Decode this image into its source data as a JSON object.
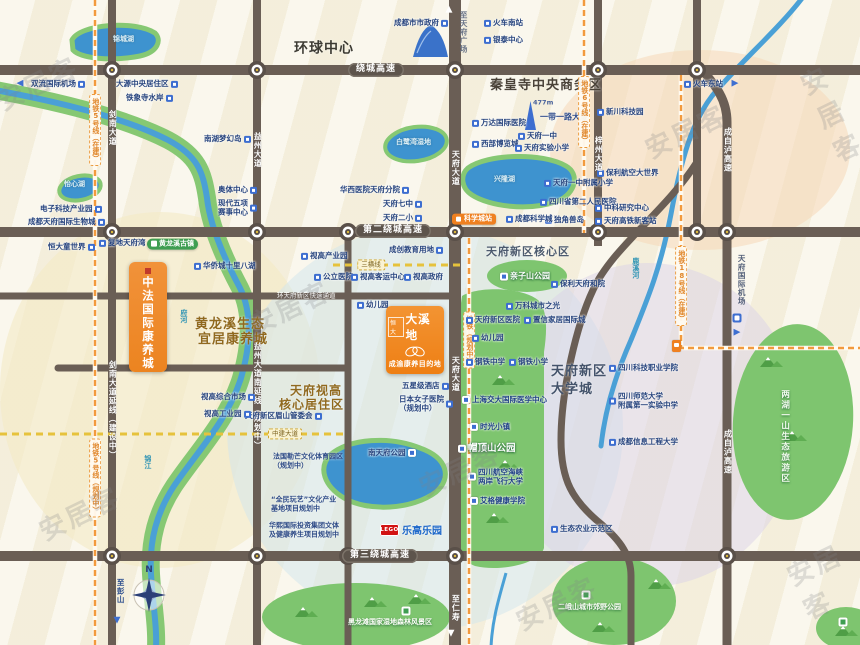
{
  "watermark": {
    "text": "安居客",
    "positions": [
      [
        -6,
        64
      ],
      [
        816,
        54
      ],
      [
        642,
        112
      ],
      [
        246,
        288
      ],
      [
        36,
        494
      ],
      [
        416,
        450
      ],
      [
        793,
        542
      ],
      [
        513,
        584
      ]
    ]
  },
  "projects": {
    "daxidi": {
      "brand": "恒大",
      "name": "大溪地",
      "tagline": "成渝康养目的地"
    },
    "zhongfa": {
      "name": "中法国际康养城"
    }
  },
  "lego": {
    "logo": "LEGO",
    "name": "乐高乐园"
  },
  "compass": {
    "n": "N"
  },
  "colors": {
    "road": "#6a5e55",
    "water": "#4aa0d6",
    "lake": "#3e93cf",
    "green": "#7ec56f",
    "riverbank": "#86c873",
    "metro_dash": "#f29a3d",
    "yellow_dash": "#e6c23c",
    "poi_icon": "#3d6ed0",
    "poi_text": "#27447e",
    "project_orange": "#ee7f14",
    "badge_orange": "#ef8020",
    "lego_red": "#d21212",
    "lego_blue": "#1b66c9"
  },
  "zones": [
    {
      "cx": 700,
      "cy": 150,
      "rx": 150,
      "ry": 100,
      "fill": "#f5d9b8",
      "op": 0.55
    },
    {
      "cx": 160,
      "cy": 390,
      "rx": 160,
      "ry": 178,
      "fill": "#f4e9c4",
      "op": 0.6
    },
    {
      "cx": 425,
      "cy": 428,
      "rx": 198,
      "ry": 202,
      "fill": "#cfe5ee",
      "op": 0.5
    },
    {
      "cx": 648,
      "cy": 425,
      "rx": 152,
      "ry": 162,
      "fill": "#d9d1e8",
      "op": 0.5
    }
  ],
  "greens": [
    {
      "e": [
        527,
        276,
        40,
        16,
        0
      ]
    },
    {
      "d": "M462,296 C478,286 522,287 538,300 C548,310 547,332 544,352 L544,548 C540,564 500,572 475,566 C464,562 460,552 460,540 L460,310 Z"
    },
    {
      "e": [
        793,
        422,
        60,
        98,
        4
      ]
    },
    {
      "e": [
        356,
        617,
        94,
        34,
        0
      ]
    },
    {
      "e": [
        614,
        601,
        62,
        44,
        0
      ]
    },
    {
      "e": [
        846,
        628,
        30,
        21,
        0
      ]
    }
  ],
  "mountains": [
    [
      500,
      380
    ],
    [
      505,
      465
    ],
    [
      494,
      518
    ],
    [
      768,
      362
    ],
    [
      792,
      436
    ],
    [
      372,
      602
    ],
    [
      416,
      599
    ],
    [
      303,
      612
    ],
    [
      600,
      627
    ],
    [
      656,
      584
    ],
    [
      843,
      631
    ]
  ],
  "rivers": {
    "main_band": "M-5,90 C60,102 125,118 168,140 C198,156 203,172 207,198 C210,226 224,258 240,288 C252,312 251,344 241,378 C228,420 197,452 174,486 C157,512 149,540 151,574 C153,606 157,626 156,648",
    "east": "M803,-3 C778,30 740,62 712,96 C692,122 681,160 671,214 C661,266 649,296 631,340 C615,376 605,410 601,446",
    "south_small": "M506,573 C499,598 492,620 491,648"
  },
  "lakes": [
    {
      "d": "M72,40 C80,24 135,20 155,33 C162,40 158,52 140,56 C110,62 80,58 73,50 Z"
    },
    {
      "e": [
        80,
        188,
        21,
        12,
        -12
      ]
    },
    {
      "e": [
        416,
        144,
        31,
        17,
        -8
      ]
    },
    {
      "d": "M468,168 C487,154 542,152 566,166 C580,174 576,193 558,201 C528,212 489,206 472,195 C461,188 460,175 468,168 Z"
    },
    {
      "d": "M330,455 C350,438 390,436 420,448 C448,458 452,478 436,492 C412,510 368,512 344,498 C324,486 318,468 330,455 Z"
    }
  ],
  "roads": {
    "highways_y": [
      70,
      232,
      556
    ],
    "verticals": [
      {
        "x": 112,
        "y1": 0,
        "y2": 645,
        "w": 8
      },
      {
        "x": 257,
        "y1": 0,
        "y2": 645,
        "w": 8
      },
      {
        "x": 348,
        "y1": 232,
        "y2": 645,
        "w": 7
      },
      {
        "x": 455,
        "y1": 0,
        "y2": 645,
        "w": 12
      },
      {
        "x": 598,
        "y1": 0,
        "y2": 246,
        "w": 8
      },
      {
        "x": 697,
        "y1": 0,
        "y2": 232,
        "w": 8
      }
    ],
    "paths": [
      {
        "d": "M699,66 C714,84 727,98 727,122 L727,648",
        "w": 9
      },
      {
        "d": "M697,162 C665,212 612,248 593,290 C577,324 561,390 561,440 C561,480 572,500 601,524 C621,541 631,556 631,576 L631,648",
        "w": 7
      },
      {
        "d": "M0,296 L455,296",
        "w": 7
      },
      {
        "d": "M58,368 L348,368",
        "w": 7
      }
    ]
  },
  "metros": [
    {
      "d": "M95,0 L95,648"
    },
    {
      "d": "M584,0 L584,233"
    },
    {
      "d": "M681,75 L681,348 L862,348"
    },
    {
      "d": "M469,238 L469,648"
    }
  ],
  "ydash": [
    {
      "d": "M333,265 L463,265"
    },
    {
      "d": "M0,434 L348,434"
    }
  ],
  "roundabouts": [
    [
      112,
      70
    ],
    [
      257,
      70
    ],
    [
      455,
      70
    ],
    [
      598,
      70
    ],
    [
      697,
      70
    ],
    [
      112,
      232
    ],
    [
      257,
      232
    ],
    [
      348,
      232
    ],
    [
      455,
      232
    ],
    [
      598,
      232
    ],
    [
      697,
      232
    ],
    [
      727,
      232
    ],
    [
      112,
      556
    ],
    [
      257,
      556
    ],
    [
      348,
      556
    ],
    [
      455,
      556
    ],
    [
      727,
      556
    ]
  ],
  "labels": [
    {
      "s": "poi",
      "t": "成都市市政府",
      "x": 394,
      "y": 23,
      "ic": "r"
    },
    {
      "s": "poi",
      "t": "火车南站",
      "x": 484,
      "y": 23
    },
    {
      "s": "poi",
      "t": "银泰中心",
      "x": 484,
      "y": 40
    },
    {
      "s": "arrow",
      "t": "◀",
      "x": 20,
      "y": 84,
      "c": "#3e6fd1"
    },
    {
      "s": "poi",
      "t": "双流国际机场",
      "x": 31,
      "y": 84,
      "ic": "r"
    },
    {
      "s": "poi",
      "t": "大源中央居住区",
      "x": 116,
      "y": 84,
      "ic": "r"
    },
    {
      "s": "poi",
      "t": "铁象寺水岸",
      "x": 126,
      "y": 98,
      "ic": "r"
    },
    {
      "s": "poi",
      "t": "南湖梦幻岛",
      "x": 204,
      "y": 139,
      "ic": "r"
    },
    {
      "s": "poi",
      "t": "火车东站",
      "x": 684,
      "y": 84
    },
    {
      "s": "arrow",
      "t": "▶",
      "x": 735,
      "y": 84,
      "c": "#3e6fd1"
    },
    {
      "s": "tealL",
      "t": "锦城湖",
      "x": 113,
      "y": 40
    },
    {
      "s": "bold",
      "t": "环球中心",
      "x": 294,
      "y": 49,
      "fs": 14,
      "c": "#3d3b33"
    },
    {
      "s": "bold",
      "t": "秦皇寺中央商务区",
      "x": 490,
      "y": 86,
      "fs": 13,
      "c": "#4a4238"
    },
    {
      "s": "sm",
      "t": "477m",
      "x": 533,
      "y": 103,
      "c": "#49629c"
    },
    {
      "s": "navy",
      "t": "一带一路大厦",
      "x": 540,
      "y": 118
    },
    {
      "s": "poi",
      "t": "万达国际医院",
      "x": 472,
      "y": 123
    },
    {
      "s": "poi",
      "t": "西部博览城",
      "x": 472,
      "y": 144
    },
    {
      "s": "poi",
      "t": "天府一中",
      "x": 518,
      "y": 136
    },
    {
      "s": "poi",
      "t": "天府实验小学",
      "x": 515,
      "y": 148
    },
    {
      "s": "darkV",
      "t": "至天府广场",
      "x": 463,
      "y": 32,
      "c": "#6a7488"
    },
    {
      "s": "arrow",
      "t": "▲",
      "x": 449,
      "y": 10,
      "c": "#ffffff"
    },
    {
      "s": "poi",
      "t": "华西医院天府分院",
      "x": 340,
      "y": 190,
      "ic": "r"
    },
    {
      "s": "poi",
      "t": "天府七中",
      "x": 383,
      "y": 204,
      "ic": "r"
    },
    {
      "s": "poi",
      "t": "天府二小",
      "x": 383,
      "y": 218,
      "ic": "r"
    },
    {
      "s": "tealL",
      "t": "白鹭湾湿地",
      "x": 396,
      "y": 143
    },
    {
      "s": "tealL",
      "t": "兴隆湖",
      "x": 494,
      "y": 180
    },
    {
      "s": "poi",
      "t": "天府一中附属小学",
      "x": 544,
      "y": 183
    },
    {
      "s": "poi",
      "t": "四川省第二人民医院",
      "x": 540,
      "y": 202
    },
    {
      "s": "poi",
      "t": "独角兽岛",
      "x": 545,
      "y": 220
    },
    {
      "s": "badge",
      "t": "科学城站",
      "x": 452,
      "y": 219
    },
    {
      "s": "poi",
      "t": "成都科学城",
      "x": 506,
      "y": 219
    },
    {
      "s": "poi",
      "t": "新川科技园",
      "x": 597,
      "y": 112
    },
    {
      "s": "poi",
      "t": "保利航空大世界",
      "x": 597,
      "y": 173
    },
    {
      "s": "poi",
      "t": "中科研究中心",
      "x": 595,
      "y": 208
    },
    {
      "s": "poi",
      "t": "天府高铁新客站",
      "x": 595,
      "y": 221
    },
    {
      "s": "metroV",
      "t": "地铁5号线（在建）",
      "x": 95,
      "y": 130
    },
    {
      "s": "metroV",
      "t": "地铁5号线（规划中）",
      "x": 95,
      "y": 478
    },
    {
      "s": "metroV",
      "t": "地铁6号线（在建）",
      "x": 584,
      "y": 112
    },
    {
      "s": "metroV",
      "t": "地铁18号线（在建）",
      "x": 681,
      "y": 286
    },
    {
      "s": "metroV",
      "t": "地铁（规划中）",
      "x": 469,
      "y": 340
    },
    {
      "s": "roadV",
      "t": "剑南大道",
      "x": 112,
      "y": 128
    },
    {
      "s": "roadV",
      "t": "剑南大道延线（建设中）",
      "x": 112,
      "y": 410
    },
    {
      "s": "roadV",
      "t": "益州大道",
      "x": 257,
      "y": 150
    },
    {
      "s": "roadV",
      "t": "益州大道南延线（规划中）",
      "x": 257,
      "y": 396
    },
    {
      "s": "roadV",
      "t": "天府大道",
      "x": 455,
      "y": 168
    },
    {
      "s": "roadV",
      "t": "天府大道",
      "x": 455,
      "y": 374
    },
    {
      "s": "roadV",
      "t": "梓州大道",
      "x": 598,
      "y": 154
    },
    {
      "s": "roadV",
      "t": "成自泸高速",
      "x": 727,
      "y": 150
    },
    {
      "s": "roadV",
      "t": "成自泸高速",
      "x": 727,
      "y": 452
    },
    {
      "s": "roadV",
      "t": "至仁寿",
      "x": 455,
      "y": 608
    },
    {
      "s": "arrow",
      "t": "▼",
      "x": 451,
      "y": 634,
      "c": "#ffffff"
    },
    {
      "s": "darkV",
      "t": "至彭山",
      "x": 120,
      "y": 591,
      "c": "#2d4e8e"
    },
    {
      "s": "arrow",
      "t": "▼",
      "x": 117,
      "y": 621,
      "c": "#3e6fd1"
    },
    {
      "s": "hwy",
      "t": "绕城高速",
      "x": 376,
      "y": 70
    },
    {
      "s": "hwy",
      "t": "第二绕城高速",
      "x": 393,
      "y": 231
    },
    {
      "s": "hwy",
      "t": "第三绕城高速",
      "x": 380,
      "y": 556
    },
    {
      "s": "poi",
      "t": "电子科技产业园",
      "x": 40,
      "y": 209,
      "ic": "r"
    },
    {
      "s": "poi",
      "t": "成都天府国际生物城",
      "x": 28,
      "y": 222,
      "ic": "r"
    },
    {
      "s": "tealL",
      "t": "怡心湖",
      "x": 64,
      "y": 185
    },
    {
      "s": "poi",
      "t": "恒大童世界",
      "x": 48,
      "y": 247,
      "ic": "r"
    },
    {
      "s": "poi",
      "t": "复地天府湾",
      "x": 99,
      "y": 243
    },
    {
      "s": "poi",
      "t": "奥体中心",
      "x": 218,
      "y": 190,
      "ic": "r"
    },
    {
      "s": "poi2",
      "t": "现代五项",
      "t2": "赛事中心",
      "x": 218,
      "y": 208,
      "ic": "r"
    },
    {
      "s": "pill",
      "t": "黄龙溪古镇",
      "x": 147,
      "y": 244
    },
    {
      "s": "poi",
      "t": "华侨城十里八湖",
      "x": 194,
      "y": 266
    },
    {
      "s": "tealV",
      "t": "府河",
      "x": 183,
      "y": 316
    },
    {
      "s": "tealV",
      "t": "锦江",
      "x": 147,
      "y": 462
    },
    {
      "s": "tealV",
      "t": "鹿溪河",
      "x": 635,
      "y": 268
    },
    {
      "s": "bold",
      "t": "黄龙溪生态",
      "x": 195,
      "y": 325,
      "fs": 13,
      "c": "#90691f"
    },
    {
      "s": "bold",
      "t": "宜居康养城",
      "x": 198,
      "y": 340,
      "fs": 13,
      "c": "#90691f"
    },
    {
      "s": "poi",
      "t": "视高产业园",
      "x": 301,
      "y": 256
    },
    {
      "s": "poi",
      "t": "公立医院",
      "x": 314,
      "y": 277
    },
    {
      "s": "roadH",
      "t": "环天府新区快速通道",
      "x": 277,
      "y": 296
    },
    {
      "s": "poi",
      "t": "成创教育用地",
      "x": 389,
      "y": 250,
      "ic": "r"
    },
    {
      "s": "ydl",
      "t": "三横线",
      "x": 371,
      "y": 265
    },
    {
      "s": "poi",
      "t": "视高客运中心",
      "x": 351,
      "y": 277
    },
    {
      "s": "poi",
      "t": "视高政府",
      "x": 404,
      "y": 277
    },
    {
      "s": "poi",
      "t": "幼儿园",
      "x": 357,
      "y": 305
    },
    {
      "s": "bold",
      "t": "天府新区核心区",
      "x": 486,
      "y": 252,
      "fs": 11,
      "c": "#4c5a6e"
    },
    {
      "s": "park",
      "t": "亲子山公园",
      "x": 500,
      "y": 277,
      "fs": 8
    },
    {
      "s": "poi",
      "t": "保利天府和院",
      "x": 551,
      "y": 284
    },
    {
      "s": "poi",
      "t": "万科城市之光",
      "x": 506,
      "y": 306
    },
    {
      "s": "poi",
      "t": "天府新区医院",
      "x": 466,
      "y": 320
    },
    {
      "s": "poi",
      "t": "置信家居国际城",
      "x": 524,
      "y": 320
    },
    {
      "s": "poi",
      "t": "幼儿园",
      "x": 472,
      "y": 338
    },
    {
      "s": "poi",
      "t": "钢铁中学",
      "x": 466,
      "y": 362
    },
    {
      "s": "poi",
      "t": "钢铁小学",
      "x": 509,
      "y": 362
    },
    {
      "s": "darkV",
      "t": "天府国际机场",
      "x": 741,
      "y": 280,
      "c": "#55617a"
    },
    {
      "s": "sq",
      "x": 737,
      "y": 318
    },
    {
      "s": "arrow",
      "t": "▶",
      "x": 737,
      "y": 333,
      "c": "#3e6fd1"
    },
    {
      "s": "poi",
      "t": "五星级酒店",
      "x": 402,
      "y": 386,
      "ic": "r"
    },
    {
      "s": "poi2",
      "t": "日本女子医院",
      "t2": "（规划中）",
      "x": 399,
      "y": 404,
      "ic": "r"
    },
    {
      "s": "bold",
      "t": "天府视高",
      "x": 290,
      "y": 391,
      "fs": 12,
      "c": "#90691f"
    },
    {
      "s": "bold",
      "t": "核心居住区",
      "x": 279,
      "y": 405,
      "fs": 12,
      "c": "#90691f"
    },
    {
      "s": "poi",
      "t": "天府新区眉山管委会",
      "x": 245,
      "y": 416,
      "ic": "r"
    },
    {
      "s": "ydl",
      "t": "中建大道",
      "x": 285,
      "y": 434
    },
    {
      "s": "note2",
      "t": "法国勒芒文化体育园区",
      "t2": "（规划中）",
      "x": 273,
      "y": 461
    },
    {
      "s": "note2",
      "t": "“全民玩艺”文化产业",
      "t2": "基地项目规划中",
      "x": 271,
      "y": 504
    },
    {
      "s": "note2",
      "t": "华熙国际投资集团文体",
      "t2": "及健康养生项目规划中",
      "x": 269,
      "y": 530
    },
    {
      "s": "poi",
      "t": "视高综合市场",
      "x": 201,
      "y": 397,
      "ic": "r"
    },
    {
      "s": "poi",
      "t": "视高工业园",
      "x": 204,
      "y": 414,
      "ic": "r"
    },
    {
      "s": "wpoi",
      "t": "南天府公园",
      "x": 368,
      "y": 453,
      "ic": "r"
    },
    {
      "s": "ongreen",
      "t": "上海交大国际医学中心",
      "x": 462,
      "y": 400
    },
    {
      "s": "ongreen",
      "t": "时光小镇",
      "x": 470,
      "y": 427
    },
    {
      "s": "park",
      "t": "帽顶山公园",
      "x": 458,
      "y": 449,
      "fs": 9.5
    },
    {
      "s": "ongreen2",
      "t": "四川航空海峡",
      "t2": "两岸飞行大学",
      "x": 468,
      "y": 477
    },
    {
      "s": "ongreen",
      "t": "艾格健康学院",
      "x": 470,
      "y": 501
    },
    {
      "s": "bold",
      "t": "天府新区",
      "x": 551,
      "y": 372,
      "fs": 13,
      "c": "#44536b"
    },
    {
      "s": "bold",
      "t": "大学城",
      "x": 551,
      "y": 390,
      "fs": 13,
      "c": "#44536b"
    },
    {
      "s": "poi",
      "t": "四川科技职业学院",
      "x": 609,
      "y": 368
    },
    {
      "s": "poi2",
      "t": "四川师范大学",
      "t2": "附属第一实验中学",
      "x": 609,
      "y": 401
    },
    {
      "s": "poi",
      "t": "成都信息工程大学",
      "x": 609,
      "y": 442
    },
    {
      "s": "whiteV",
      "t": "两湖一山生态旅游区",
      "x": 784,
      "y": 437
    },
    {
      "s": "poi",
      "t": "生态农业示范区",
      "x": 551,
      "y": 529
    },
    {
      "s": "hillic",
      "x": 586,
      "y": 595
    },
    {
      "s": "parksm",
      "t": "二峨山城市郊野公园",
      "x": 558,
      "y": 608
    },
    {
      "s": "hillic",
      "x": 406,
      "y": 611
    },
    {
      "s": "parksm",
      "t": "黑龙滩国家湿地森林风景区",
      "x": 348,
      "y": 623
    },
    {
      "s": "hillic",
      "x": 843,
      "y": 622
    }
  ]
}
